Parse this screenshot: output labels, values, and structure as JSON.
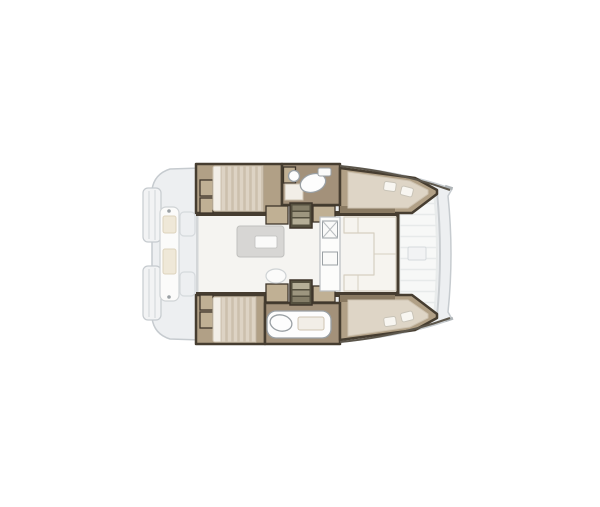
{
  "figure": {
    "type": "boat-floorplan",
    "description": "Catamaran interior layout plan, top view, bow facing right",
    "areas": [
      {
        "name": "stern-swim-platforms"
      },
      {
        "name": "aft-cockpit-bench"
      },
      {
        "name": "port-aft-cabin-double-bed"
      },
      {
        "name": "port-bathroom-toilet-sink"
      },
      {
        "name": "port-forward-cabin-double-bed"
      },
      {
        "name": "saloon-cockpit-table"
      },
      {
        "name": "galley-with-sink"
      },
      {
        "name": "forward-u-sofa"
      },
      {
        "name": "starboard-aft-cabin-double-bed"
      },
      {
        "name": "starboard-bathroom-toilet"
      },
      {
        "name": "starboard-forward-cabin-double-bed"
      },
      {
        "name": "bow-trampoline"
      }
    ]
  },
  "colors": {
    "background": "#ffffff",
    "outline": "#c6cbcf",
    "deck": "#edeff1",
    "deck_light": "#f2f3f4",
    "step_line": "#d6dadd",
    "wall": "#463d30",
    "wall_light": "#5c564b",
    "hull_floor": "#b1a086",
    "hull_floor_dark": "#a3917a",
    "floor_shadow": "#8a7a62",
    "locker": "#c0b094",
    "locker_edge": "#3e352a",
    "mattress": "#ddd3c4",
    "mattress_stripe": "#ccc0ad",
    "bed": "#ded5c6",
    "bed_edge": "#cfc4b2",
    "pillow": "#f8f6f1",
    "pillow_edge": "#c9c4b8",
    "duvet": "#f2eee7",
    "saloon": "#f5f4f1",
    "saloon_wall": "#d3d6d8",
    "table": "#d7d6d4",
    "table_edge": "#c0c0be",
    "pad": "#fafaf9",
    "sofa": "#f6f4ef",
    "sofa_edge": "#d6cfc1",
    "cushion": "#efe8d8",
    "cushion_edge": "#ddd3bd",
    "galley": "#fcfcfb",
    "galley_edge": "#b9bdc0",
    "fixture": "#fdfdfd",
    "fixture_edge": "#9aa0a4",
    "steps_frame": "#55503f",
    "tread_light": "#b5ae97",
    "tread_mid": "#9d967f",
    "tread_dark": "#857e68",
    "tramp": "#f7f8f7",
    "tramp_line": "#e7eaea",
    "beam": "#c9cdd0",
    "bench": "#fbfbfa",
    "bench_edge": "#cfd3d5",
    "metal": "#b0b5b8"
  }
}
